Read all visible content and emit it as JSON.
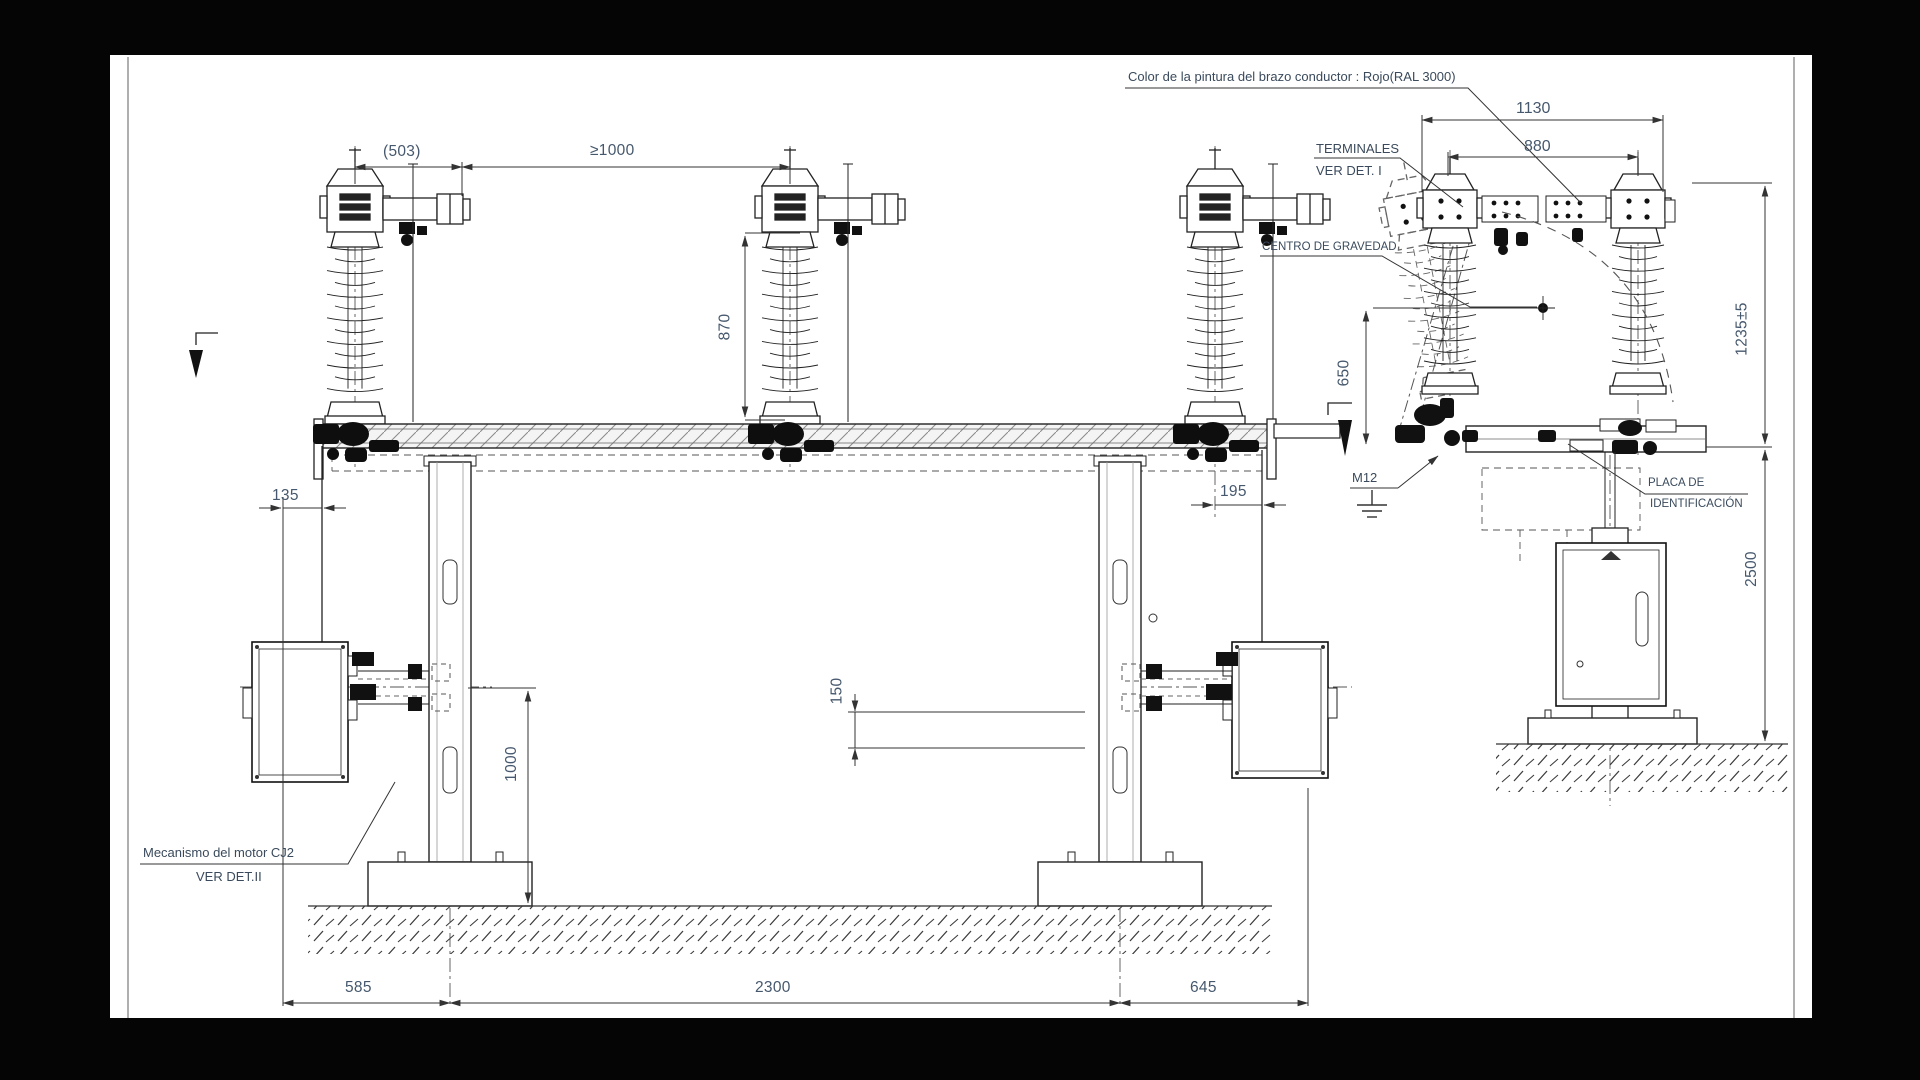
{
  "scene": {
    "background_color": "#050505",
    "sheet_color": "#ffffff",
    "line_color": "#2a2a2a",
    "dimension_text_color": "#46586d",
    "callout_text_color": "#3a4a5c",
    "conductor_arm_color_note_value": "Rojo(RAL 3000)"
  },
  "callouts": {
    "color_note": "Color de la pintura del brazo conductor : Rojo(RAL 3000)",
    "terminales_line1": "TERMINALES",
    "terminales_line2": "VER DET. I",
    "centro_gravedad": "CENTRO DE GRAVEDAD",
    "m12": "M12",
    "placa_line1": "PLACA DE",
    "placa_line2": "IDENTIFICACIÓN",
    "mecanismo_line1": "Mecanismo del motor CJ2",
    "mecanismo_line2": "VER DET.II"
  },
  "dimensions": {
    "d503": "(503)",
    "ge1000": "≥1000",
    "d870": "870",
    "d1130": "1130",
    "d880": "880",
    "d1235": "1235±5",
    "d650": "650",
    "d135": "135",
    "d195": "195",
    "d1000": "1000",
    "d150": "150",
    "d585": "585",
    "d2300": "2300",
    "d645": "645",
    "d2500": "2500"
  },
  "views": {
    "front_view": "vista frontal - seccionador tripolar",
    "side_view": "vista lateral"
  }
}
